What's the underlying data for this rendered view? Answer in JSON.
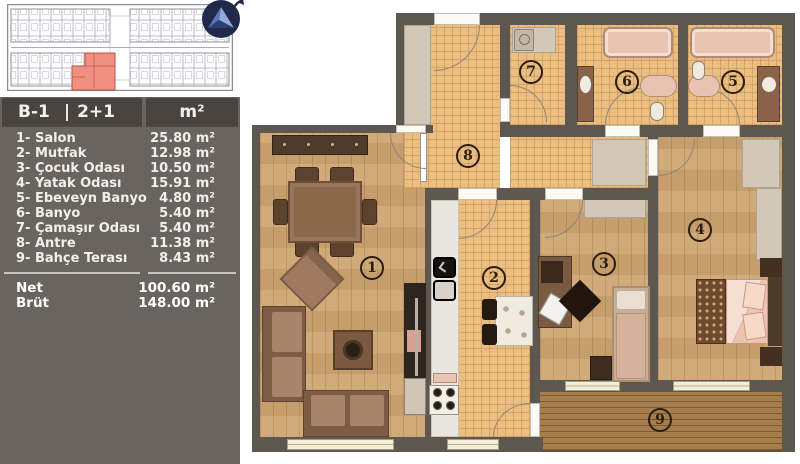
{
  "sidebar": {
    "unit_code": "B-1",
    "unit_separator": "|",
    "unit_type": "2+1",
    "area_unit_header": "m²",
    "legend": [
      {
        "label": "1- Salon",
        "area": "25.80 m²"
      },
      {
        "label": "2- Mutfak",
        "area": "12.98 m²"
      },
      {
        "label": "3- Çocuk Odası",
        "area": "10.50 m²"
      },
      {
        "label": "4- Yatak Odası",
        "area": "15.91 m²"
      },
      {
        "label": "5- Ebeveyn Banyo",
        "area": "4.80 m²"
      },
      {
        "label": "6- Banyo",
        "area": "5.40 m²"
      },
      {
        "label": "7- Çamaşır Odası",
        "area": "5.40 m²"
      },
      {
        "label": "8- Antre",
        "area": "11.38 m²"
      },
      {
        "label": "9- Bahçe Terası",
        "area": "8.43 m²"
      }
    ],
    "totals": [
      {
        "label": "Net",
        "area": "100.60 m²"
      },
      {
        "label": "Brüt",
        "area": "148.00 m²"
      }
    ]
  },
  "plan": {
    "markers": [
      "1",
      "2",
      "3",
      "4",
      "5",
      "6",
      "7",
      "8",
      "9"
    ]
  },
  "colors": {
    "sidebar_bg": "#6a645f",
    "header_bg": "#49443d",
    "wall": "#5e574f",
    "keyplan_highlight": "#ef9082",
    "logo_navy": "#20294a"
  }
}
